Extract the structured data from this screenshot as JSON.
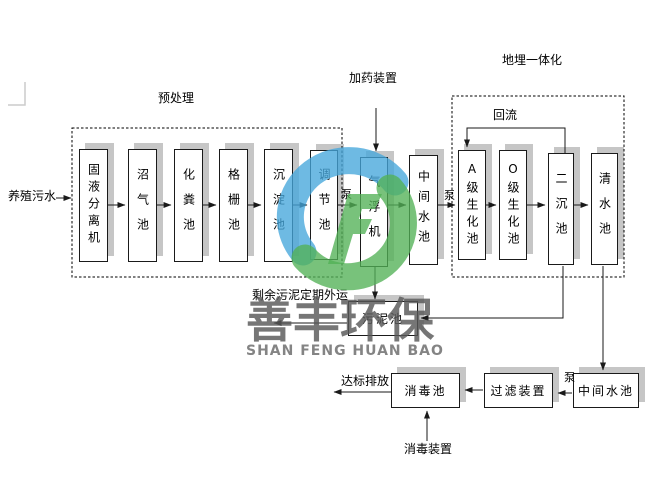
{
  "diagram": {
    "inlet_label": "养殖污水",
    "sections": {
      "pretreatment": "预处理",
      "underground": "地埋一体化"
    },
    "labels": {
      "dosing": "加药装置",
      "reflux": "回流",
      "pump": "泵",
      "sludge_out": "剩余污泥定期外运",
      "discharge": "达标排放",
      "disinfection": "消毒装置"
    },
    "main_boxes": [
      {
        "id": "solid-liquid-separator",
        "label": "固液分离机"
      },
      {
        "id": "biogas-tank",
        "label": "沼气池"
      },
      {
        "id": "septic-tank",
        "label": "化粪池"
      },
      {
        "id": "grid-tank",
        "label": "格栅池"
      },
      {
        "id": "sedimentation-tank",
        "label": "沉淀池"
      },
      {
        "id": "regulating-tank",
        "label": "调节池"
      },
      {
        "id": "air-flotation-machine",
        "label": "气浮机"
      },
      {
        "id": "intermediate-tank",
        "label": "中间水池"
      },
      {
        "id": "a-grade-bio-tank",
        "label": "A级生化池"
      },
      {
        "id": "o-grade-bio-tank",
        "label": "O级生化池"
      },
      {
        "id": "secondary-sedimentation-tank",
        "label": "二沉池"
      },
      {
        "id": "clear-water-tank",
        "label": "清水池"
      }
    ],
    "sludge_box": {
      "label": "污泥池"
    },
    "bottom_boxes": [
      {
        "id": "disinfection-tank",
        "label": "消毒池"
      },
      {
        "id": "filter-device",
        "label": "过滤装置"
      },
      {
        "id": "intermediate-tank-2",
        "label": "中间水池"
      }
    ],
    "watermark": {
      "cn": "善丰环保",
      "en": "SHAN FENG HUAN BAO"
    },
    "colors": {
      "logo_blue": "#45a7db",
      "logo_green": "#52b156",
      "box_shadow": "#c6c6c6",
      "line": "#1a1a1a",
      "watermark_text": "#6b6b6b"
    }
  }
}
